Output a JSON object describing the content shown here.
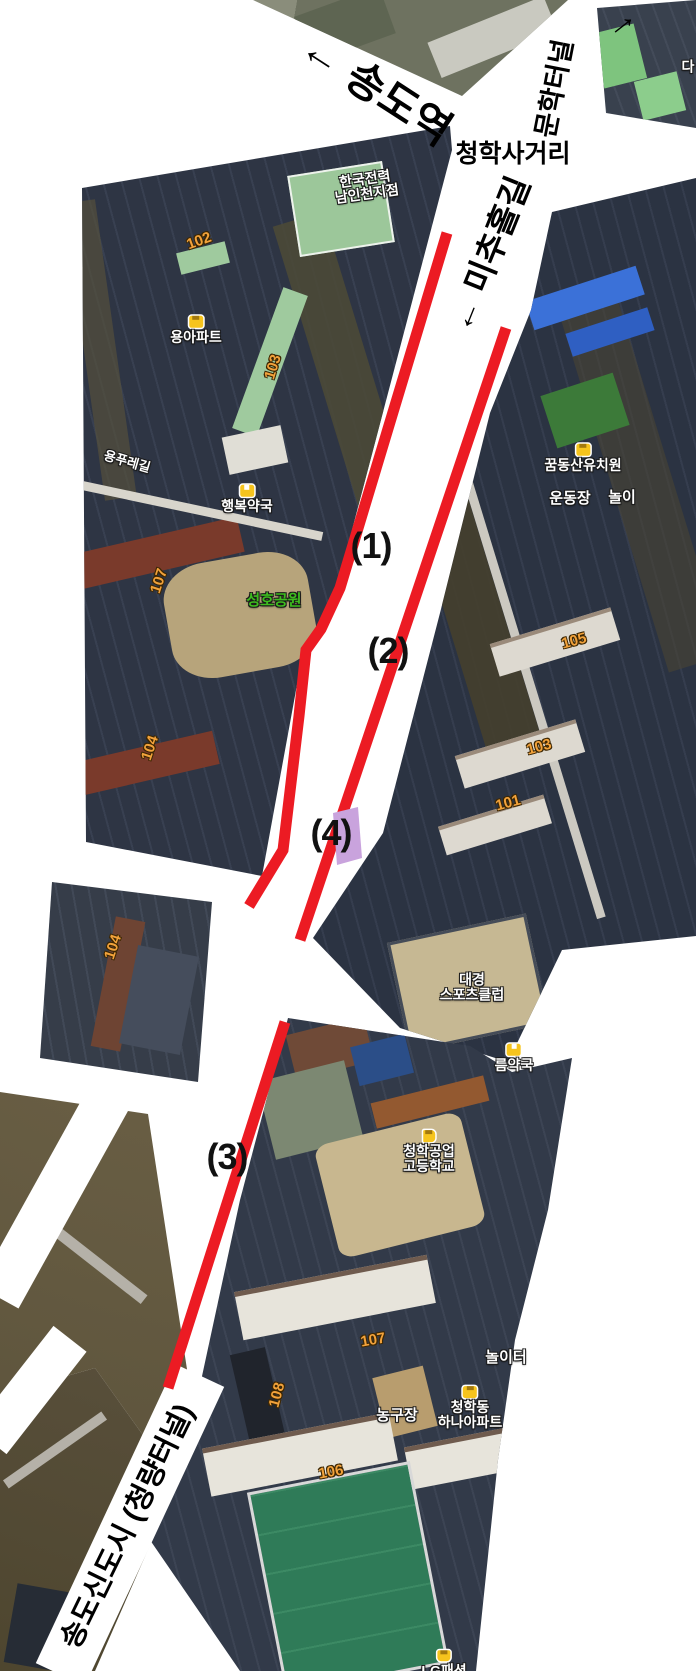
{
  "canvas": {
    "width": 696,
    "height": 1671,
    "background": "#ffffff"
  },
  "colors": {
    "route_line": "#ec1b23",
    "zone_fill": "#c9a3dd",
    "building_number": "#f2a23b",
    "place_text": "#ffffff",
    "park_text": "#3dbb1e",
    "road_text": "#000000"
  },
  "road_labels": [
    {
      "id": "songdo-station",
      "text": "← 송도역",
      "x": 378,
      "y": 86,
      "rotate": 33,
      "size": 42
    },
    {
      "id": "munhak-tunnel",
      "text": "문학터널",
      "x": 552,
      "y": 88,
      "rotate": -79,
      "size": 27
    },
    {
      "id": "munhak-tunnel-arrow",
      "text": "→",
      "x": 620,
      "y": 22,
      "rotate": -38,
      "size": 34
    },
    {
      "id": "cheonghak-intersection",
      "text": "청학사거리",
      "x": 513,
      "y": 152,
      "rotate": 0,
      "size": 25
    },
    {
      "id": "michuhol-gil",
      "text": "← 미추홀길",
      "x": 487,
      "y": 253,
      "rotate": -68,
      "size": 33
    },
    {
      "id": "songdo-newtown-tunnel",
      "text": "송도신도시 (청량터널)",
      "x": 125,
      "y": 1525,
      "rotate": -64,
      "size": 29
    }
  ],
  "route_numbers": [
    {
      "id": "1",
      "text": "(1)",
      "x": 371,
      "y": 546
    },
    {
      "id": "2",
      "text": "(2)",
      "x": 388,
      "y": 651
    },
    {
      "id": "3",
      "text": "(3)",
      "x": 227,
      "y": 1157
    },
    {
      "id": "4",
      "text": "(4)",
      "x": 331,
      "y": 833
    }
  ],
  "place_labels": [
    {
      "id": "kepco-nam-incheon",
      "lines": [
        "한국전력",
        "남인천지점"
      ],
      "x": 366,
      "y": 187,
      "rotate": -8,
      "size": 14,
      "icon": null,
      "color": null
    },
    {
      "id": "yong-apartment",
      "lines": [
        "용아파트"
      ],
      "x": 196,
      "y": 329,
      "rotate": 0,
      "size": 14,
      "icon": "building",
      "color": null
    },
    {
      "id": "pure-gil-road",
      "lines": [
        "용푸레길"
      ],
      "x": 127,
      "y": 462,
      "rotate": 16,
      "size": 13,
      "icon": null,
      "color": null
    },
    {
      "id": "haengbok-pharmacy",
      "lines": [
        "행복약국"
      ],
      "x": 247,
      "y": 498,
      "rotate": 0,
      "size": 14,
      "icon": "pharmacy",
      "color": null
    },
    {
      "id": "seongho-park",
      "lines": [
        "성호공원"
      ],
      "x": 274,
      "y": 601,
      "rotate": 0,
      "size": 15,
      "icon": null,
      "color": "#3dbb1e"
    },
    {
      "id": "kkumdongsan-kindergarten",
      "lines": [
        "꿈동산유치원"
      ],
      "x": 583,
      "y": 457,
      "rotate": 0,
      "size": 14,
      "icon": "person",
      "color": null
    },
    {
      "id": "sports-field",
      "lines": [
        "운동장"
      ],
      "x": 570,
      "y": 499,
      "rotate": 0,
      "size": 15,
      "icon": null,
      "color": null
    },
    {
      "id": "playground-clipped",
      "lines": [
        "놀이"
      ],
      "x": 622,
      "y": 498,
      "rotate": 0,
      "size": 15,
      "icon": null,
      "color": null
    },
    {
      "id": "daekyung-sports-club",
      "lines": [
        "대경",
        "스포츠클럽"
      ],
      "x": 472,
      "y": 988,
      "rotate": 0,
      "size": 14,
      "icon": null,
      "color": null
    },
    {
      "id": "pharmacy-clipped",
      "lines": [
        "름약국"
      ],
      "x": 514,
      "y": 1057,
      "rotate": 0,
      "size": 14,
      "icon": "pharmacy",
      "color": null
    },
    {
      "id": "cheonghak-technical-high-school",
      "lines": [
        "청학공업",
        "고등학교"
      ],
      "x": 429,
      "y": 1151,
      "rotate": 0,
      "size": 14,
      "icon": "flag",
      "color": null
    },
    {
      "id": "playground2",
      "lines": [
        "놀이터"
      ],
      "x": 506,
      "y": 1358,
      "rotate": 0,
      "size": 15,
      "icon": null,
      "color": null
    },
    {
      "id": "basketball-court",
      "lines": [
        "농구장"
      ],
      "x": 397,
      "y": 1416,
      "rotate": 0,
      "size": 15,
      "icon": null,
      "color": null
    },
    {
      "id": "cheonghak-hana-apartment",
      "lines": [
        "청학동",
        "하나아파트"
      ],
      "x": 470,
      "y": 1407,
      "rotate": 0,
      "size": 14,
      "icon": "building",
      "color": null
    },
    {
      "id": "lg-fashion",
      "lines": [
        "LG패션"
      ],
      "x": 444,
      "y": 1663,
      "rotate": 0,
      "size": 14,
      "icon": "bag",
      "color": null
    },
    {
      "id": "da-clipped",
      "lines": [
        "다"
      ],
      "x": 688,
      "y": 67,
      "rotate": 0,
      "size": 14,
      "icon": null,
      "color": null
    }
  ],
  "building_numbers": [
    {
      "text": "102",
      "x": 199,
      "y": 241,
      "rotate": -20
    },
    {
      "text": "103",
      "x": 273,
      "y": 367,
      "rotate": -73
    },
    {
      "text": "107",
      "x": 159,
      "y": 581,
      "rotate": -72
    },
    {
      "text": "104",
      "x": 150,
      "y": 748,
      "rotate": -72
    },
    {
      "text": "105",
      "x": 574,
      "y": 641,
      "rotate": -15
    },
    {
      "text": "103",
      "x": 539,
      "y": 747,
      "rotate": -15
    },
    {
      "text": "101",
      "x": 508,
      "y": 803,
      "rotate": -15
    },
    {
      "text": "104",
      "x": 113,
      "y": 947,
      "rotate": -72
    },
    {
      "text": "107",
      "x": 373,
      "y": 1340,
      "rotate": -10
    },
    {
      "text": "108",
      "x": 277,
      "y": 1395,
      "rotate": -75
    },
    {
      "text": "106",
      "x": 331,
      "y": 1472,
      "rotate": -10
    }
  ],
  "route_lines": [
    {
      "id": "route-segment-1",
      "points": "447,233 340,588 321,629 306,650 299,716 283,850 249,906",
      "width": 11
    },
    {
      "id": "route-segment-2",
      "points": "506,328 300,940",
      "width": 11
    },
    {
      "id": "route-segment-3",
      "points": "285,1022 168,1388",
      "width": 11
    }
  ],
  "zone": {
    "id": "zone-4",
    "points": "333,813 358,807 362,858 337,865"
  }
}
